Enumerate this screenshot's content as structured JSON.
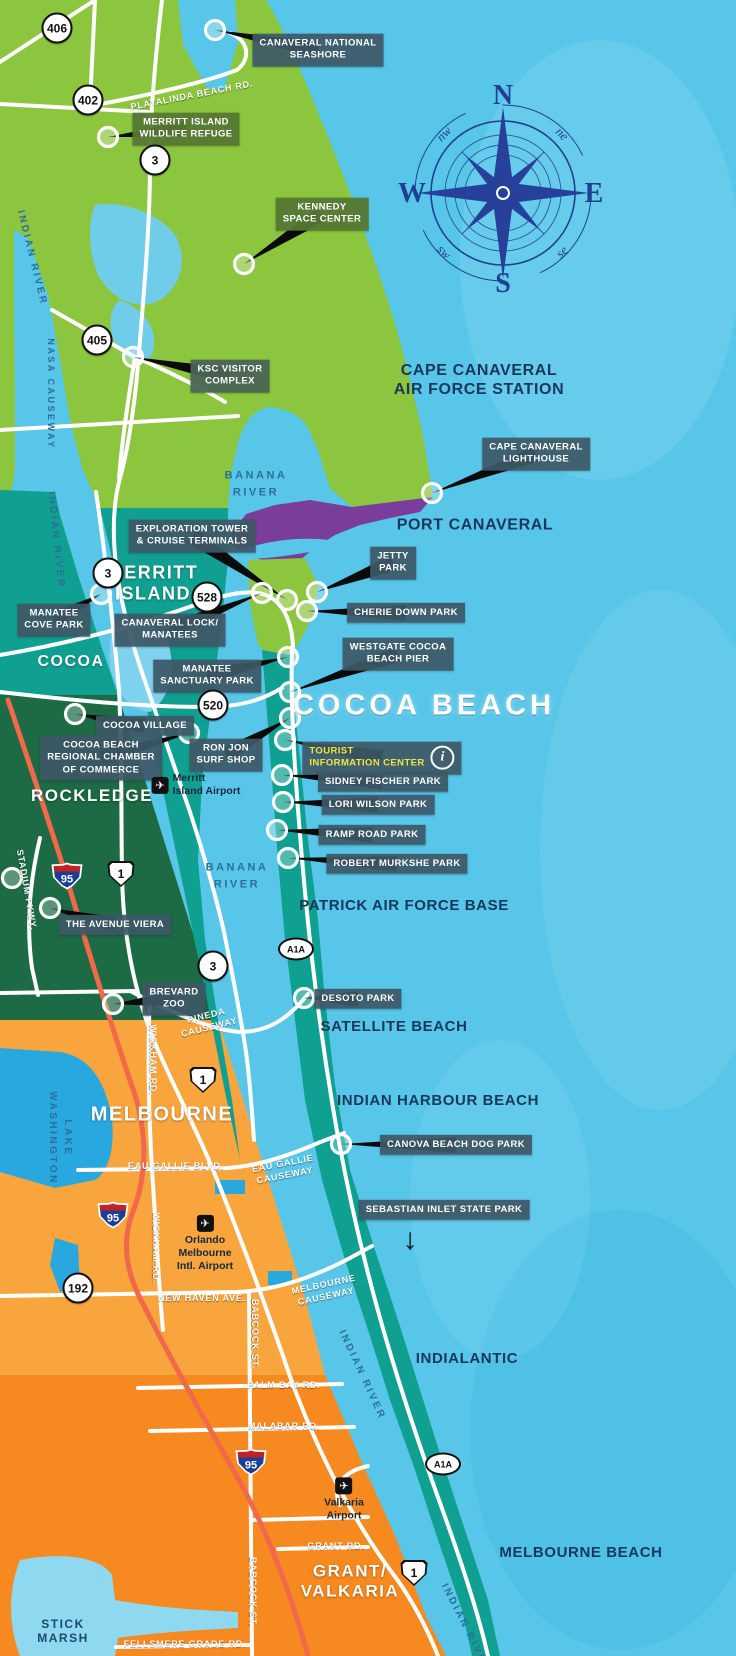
{
  "map_title": "Cocoa Beach / Space Coast Area Tourist Map",
  "compass": {
    "n": "N",
    "e": "E",
    "s": "S",
    "w": "W",
    "ne": "ne",
    "nw": "nw",
    "se": "se",
    "sw": "sw"
  },
  "colors": {
    "ocean": "#58c6e9",
    "green": "#8cc63e",
    "teal": "#10a091",
    "purple": "#7a3d9c",
    "dark_green": "#1c6b45",
    "orange": "#f9a53d",
    "dark_orange": "#f6891f",
    "lake": "#29a8e0",
    "road": "#ffffff",
    "i95_line": "#f2684a",
    "steel_box": "#3d5866",
    "olive_box": "#567834",
    "navy_text": "#17375c",
    "yellow_text": "#f0e83c"
  },
  "poi": [
    {
      "id": "canaveral-national-seashore",
      "lines": [
        "CANAVERAL NATIONAL",
        "SEASHORE"
      ],
      "style": "steel",
      "box": [
        318,
        50
      ],
      "marker": [
        215,
        30
      ]
    },
    {
      "id": "merritt-island-wildlife-refuge",
      "lines": [
        "MERRITT ISLAND",
        "WILDLIFE REFUGE"
      ],
      "style": "olive",
      "box": [
        186,
        129
      ],
      "marker": [
        108,
        137
      ]
    },
    {
      "id": "kennedy-space-center",
      "lines": [
        "KENNEDY",
        "SPACE CENTER"
      ],
      "style": "olive",
      "box": [
        322,
        214
      ],
      "marker": [
        244,
        264
      ]
    },
    {
      "id": "ksc-visitor-complex",
      "lines": [
        "KSC VISITOR",
        "COMPLEX"
      ],
      "style": "sage",
      "box": [
        230,
        376
      ],
      "marker": [
        133,
        357
      ]
    },
    {
      "id": "cape-canaveral-lighthouse",
      "lines": [
        "CAPE CANAVERAL",
        "LIGHTHOUSE"
      ],
      "style": "steel",
      "box": [
        536,
        454
      ],
      "marker": [
        432,
        493
      ]
    },
    {
      "id": "exploration-tower-cruise-terminals",
      "lines": [
        "EXPLORATION TOWER",
        "& CRUISE TERMINALS"
      ],
      "style": "steel",
      "box": [
        192,
        536
      ],
      "marker": [
        287,
        600
      ]
    },
    {
      "id": "jetty-park",
      "lines": [
        "JETTY",
        "PARK"
      ],
      "style": "steel",
      "box": [
        393,
        563
      ],
      "marker": [
        317,
        592
      ]
    },
    {
      "id": "cherie-down-park",
      "lines": [
        "CHERIE DOWN PARK"
      ],
      "style": "steel",
      "box": [
        406,
        613
      ],
      "marker": [
        307,
        611
      ]
    },
    {
      "id": "manatee-cove-park",
      "lines": [
        "MANATEE",
        "COVE PARK"
      ],
      "style": "steel",
      "box": [
        54,
        620
      ],
      "marker": [
        101,
        594
      ]
    },
    {
      "id": "canaveral-lock-manatees",
      "lines": [
        "CANAVERAL LOCK/",
        "MANATEES"
      ],
      "style": "steel",
      "box": [
        170,
        630
      ],
      "marker": [
        262,
        593
      ]
    },
    {
      "id": "westgate-cocoa-beach-pier",
      "lines": [
        "WESTGATE COCOA",
        "BEACH PIER"
      ],
      "style": "steel",
      "box": [
        398,
        654
      ],
      "marker": [
        290,
        692
      ]
    },
    {
      "id": "manatee-sanctuary-park",
      "lines": [
        "MANATEE",
        "SANCTUARY PARK"
      ],
      "style": "steel",
      "box": [
        207,
        676
      ],
      "marker": [
        288,
        657
      ]
    },
    {
      "id": "cocoa-village",
      "lines": [
        "COCOA VILLAGE"
      ],
      "style": "steel",
      "box": [
        145,
        726
      ],
      "marker": [
        75,
        714
      ]
    },
    {
      "id": "cocoa-beach-regional-chamber-of-commerce",
      "lines": [
        "COCOA BEACH",
        "REGIONAL CHAMBER",
        "OF COMMERCE"
      ],
      "style": "steel",
      "box": [
        101,
        758
      ],
      "marker": [
        189,
        733
      ]
    },
    {
      "id": "ron-jon-surf-shop",
      "lines": [
        "RON JON",
        "SURF SHOP"
      ],
      "style": "steel",
      "box": [
        226,
        755
      ],
      "marker": [
        290,
        718
      ]
    },
    {
      "id": "tourist-information-center",
      "lines": [
        "TOURIST",
        "INFORMATION CENTER"
      ],
      "style": "steel",
      "tourist": true,
      "box": [
        382,
        758
      ],
      "marker": [
        285,
        740
      ]
    },
    {
      "id": "sidney-fischer-park",
      "lines": [
        "SIDNEY FISCHER PARK"
      ],
      "style": "steel",
      "box": [
        383,
        782
      ],
      "marker": [
        282,
        775
      ]
    },
    {
      "id": "lori-wilson-park",
      "lines": [
        "LORI WILSON PARK"
      ],
      "style": "steel",
      "box": [
        378,
        805
      ],
      "marker": [
        283,
        802
      ]
    },
    {
      "id": "ramp-road-park",
      "lines": [
        "RAMP ROAD PARK"
      ],
      "style": "steel",
      "box": [
        372,
        835
      ],
      "marker": [
        277,
        830
      ]
    },
    {
      "id": "robert-murkshe-park",
      "lines": [
        "ROBERT MURKSHE PARK"
      ],
      "style": "steel",
      "box": [
        397,
        864
      ],
      "marker": [
        288,
        858
      ]
    },
    {
      "id": "the-avenue-viera",
      "lines": [
        "THE AVENUE VIERA"
      ],
      "style": "steel",
      "box": [
        115,
        925
      ],
      "marker": [
        50,
        908
      ]
    },
    {
      "id": "brevard-zoo",
      "lines": [
        "BREVARD",
        "ZOO"
      ],
      "style": "steel",
      "box": [
        174,
        999
      ],
      "marker": [
        113,
        1004
      ]
    },
    {
      "id": "desoto-park",
      "lines": [
        "DESOTO PARK"
      ],
      "style": "steel",
      "box": [
        358,
        999
      ],
      "marker": [
        304,
        998
      ]
    },
    {
      "id": "canova-beach-dog-park",
      "lines": [
        "CANOVA BEACH DOG PARK"
      ],
      "style": "steel",
      "box": [
        456,
        1145
      ],
      "marker": [
        341,
        1144
      ]
    },
    {
      "id": "sebastian-inlet-state-park",
      "lines": [
        "SEBASTIAN INLET STATE PARK"
      ],
      "style": "steel",
      "box": [
        444,
        1210
      ],
      "marker": null
    }
  ],
  "extra_markers": [
    [
      12,
      878
    ]
  ],
  "cities": [
    {
      "id": "merritt-island",
      "lines": [
        "MERRITT",
        "ISLAND"
      ],
      "x": 153,
      "y": 583,
      "size": 18
    },
    {
      "id": "cocoa",
      "lines": [
        "COCOA"
      ],
      "x": 71,
      "y": 662,
      "size": 16
    },
    {
      "id": "rockledge",
      "lines": [
        "ROCKLEDGE"
      ],
      "x": 92,
      "y": 796,
      "size": 17
    },
    {
      "id": "melbourne",
      "lines": [
        "MELBOURNE"
      ],
      "x": 162,
      "y": 1115,
      "size": 20
    },
    {
      "id": "grant-valkaria",
      "lines": [
        "GRANT/",
        "VALKARIA"
      ],
      "x": 350,
      "y": 1581,
      "size": 17
    }
  ],
  "areas": [
    {
      "id": "cape-canaveral-air-force-station",
      "lines": [
        "CAPE CANAVERAL",
        "AIR FORCE STATION"
      ],
      "x": 479,
      "y": 380,
      "size": 16
    },
    {
      "id": "port-canaveral",
      "lines": [
        "PORT CANAVERAL"
      ],
      "x": 475,
      "y": 525,
      "size": 16
    },
    {
      "id": "cocoa-beach",
      "lines": [
        "COCOA BEACH"
      ],
      "x": 424,
      "y": 706,
      "size": 29,
      "hero": true
    },
    {
      "id": "patrick-air-force-base",
      "lines": [
        "PATRICK AIR FORCE BASE"
      ],
      "x": 404,
      "y": 906,
      "size": 15
    },
    {
      "id": "satellite-beach",
      "lines": [
        "SATELLITE BEACH"
      ],
      "x": 394,
      "y": 1027,
      "size": 15
    },
    {
      "id": "indian-harbour-beach",
      "lines": [
        "INDIAN HARBOUR BEACH"
      ],
      "x": 438,
      "y": 1101,
      "size": 15
    },
    {
      "id": "indialantic",
      "lines": [
        "INDIALANTIC"
      ],
      "x": 467,
      "y": 1359,
      "size": 15
    },
    {
      "id": "melbourne-beach",
      "lines": [
        "MELBOURNE BEACH"
      ],
      "x": 581,
      "y": 1553,
      "size": 15
    }
  ],
  "waters": [
    {
      "id": "indian-river-n",
      "lines": [
        "INDIAN RIVER"
      ],
      "x": 32,
      "y": 258,
      "rot": 76,
      "size": 10
    },
    {
      "id": "nasa-causeway",
      "lines": [
        "NASA CAUSEWAY"
      ],
      "x": 50,
      "y": 394,
      "rot": 90,
      "size": 9
    },
    {
      "id": "indian-river-mid",
      "lines": [
        "INDIAN RIVER"
      ],
      "x": 56,
      "y": 540,
      "rot": 84,
      "size": 10
    },
    {
      "id": "banana-river-n",
      "lines": [
        "BANANA",
        "RIVER"
      ],
      "x": 256,
      "y": 484,
      "rot": 0,
      "size": 11
    },
    {
      "id": "banana-river-s",
      "lines": [
        "BANANA",
        "RIVER"
      ],
      "x": 237,
      "y": 876,
      "rot": 0,
      "size": 11
    },
    {
      "id": "lake-washington",
      "lines": [
        "LAKE",
        "WASHINGTON"
      ],
      "x": 60,
      "y": 1138,
      "rot": 90,
      "size": 10
    },
    {
      "id": "indian-river-s1",
      "lines": [
        "INDIAN RIVER"
      ],
      "x": 362,
      "y": 1375,
      "rot": 65,
      "size": 10
    },
    {
      "id": "indian-river-s2",
      "lines": [
        "INDIAN RIVER"
      ],
      "x": 466,
      "y": 1628,
      "rot": 63,
      "size": 10
    }
  ],
  "stick_marsh": {
    "id": "stick-marsh",
    "lines": [
      "STICK",
      "MARSH"
    ],
    "x": 63,
    "y": 1631,
    "size": 12
  },
  "road_labels": [
    {
      "id": "playalinda-beach-rd",
      "lines": [
        "PLAYALINDA BEACH RD."
      ],
      "x": 192,
      "y": 96,
      "rot": -11
    },
    {
      "id": "pineda-causeway",
      "lines": [
        "PINEDA",
        "CAUSEWAY"
      ],
      "x": 208,
      "y": 1022,
      "rot": -14
    },
    {
      "id": "eau-gallie-blvd",
      "lines": [
        "EAU GALLIE BLVD."
      ],
      "x": 176,
      "y": 1167,
      "rot": 0
    },
    {
      "id": "eau-gallie-causeway",
      "lines": [
        "EAU GALLIE",
        "CAUSEWAY"
      ],
      "x": 284,
      "y": 1170,
      "rot": -11
    },
    {
      "id": "new-haven-ave",
      "lines": [
        "NEW HAVEN AVE."
      ],
      "x": 202,
      "y": 1299,
      "rot": 0
    },
    {
      "id": "melbourne-causeway",
      "lines": [
        "MELBOURNE",
        "CAUSEWAY"
      ],
      "x": 325,
      "y": 1291,
      "rot": -12
    },
    {
      "id": "palm-bay-rd",
      "lines": [
        "PALM BAY RD."
      ],
      "x": 284,
      "y": 1386,
      "rot": 0
    },
    {
      "id": "malabar-rd",
      "lines": [
        "MALABAR RD."
      ],
      "x": 284,
      "y": 1427,
      "rot": 0
    },
    {
      "id": "grant-rd",
      "lines": [
        "GRANT RD."
      ],
      "x": 336,
      "y": 1547,
      "rot": 0
    },
    {
      "id": "fellsmere-grade-rd",
      "lines": [
        "FELLSMERE GRADE  RD."
      ],
      "x": 185,
      "y": 1645,
      "rot": 0
    },
    {
      "id": "wickham-rd-n",
      "lines": [
        "WICKHAM RD."
      ],
      "x": 152,
      "y": 1060,
      "rot": 90
    },
    {
      "id": "wickham-rd-s",
      "lines": [
        "WICKHAM RD."
      ],
      "x": 155,
      "y": 1248,
      "rot": 90
    },
    {
      "id": "babcock-st-n",
      "lines": [
        "BABCOCK ST."
      ],
      "x": 254,
      "y": 1334,
      "rot": 90
    },
    {
      "id": "babcock-st-s",
      "lines": [
        "BABCOCK ST."
      ],
      "x": 252,
      "y": 1592,
      "rot": 90
    },
    {
      "id": "stadium-pkwy",
      "lines": [
        "STADIUM PKWY."
      ],
      "x": 26,
      "y": 890,
      "rot": 80
    }
  ],
  "shields": [
    {
      "type": "circle",
      "text": "406",
      "x": 57,
      "y": 28
    },
    {
      "type": "circle",
      "text": "402",
      "x": 88,
      "y": 100
    },
    {
      "type": "circle",
      "text": "3",
      "x": 155,
      "y": 160
    },
    {
      "type": "circle",
      "text": "405",
      "x": 97,
      "y": 340
    },
    {
      "type": "circle",
      "text": "3",
      "x": 108,
      "y": 573
    },
    {
      "type": "circle",
      "text": "528",
      "x": 207,
      "y": 597
    },
    {
      "type": "circle",
      "text": "520",
      "x": 213,
      "y": 705
    },
    {
      "type": "circle",
      "text": "3",
      "x": 213,
      "y": 966
    },
    {
      "type": "circle",
      "text": "192",
      "x": 78,
      "y": 1288
    },
    {
      "type": "us",
      "text": "1",
      "x": 121,
      "y": 874
    },
    {
      "type": "us",
      "text": "1",
      "x": 203,
      "y": 1080
    },
    {
      "type": "us",
      "text": "1",
      "x": 414,
      "y": 1573
    },
    {
      "type": "i95",
      "text": "95",
      "x": 67,
      "y": 876
    },
    {
      "type": "i95",
      "text": "95",
      "x": 113,
      "y": 1215
    },
    {
      "type": "i95",
      "text": "95",
      "x": 251,
      "y": 1462
    },
    {
      "type": "a1a",
      "text": "A1A",
      "x": 296,
      "y": 949
    },
    {
      "type": "a1a",
      "text": "A1A",
      "x": 443,
      "y": 1464
    }
  ],
  "airports": [
    {
      "id": "merritt-island-airport",
      "lines": [
        "Merritt",
        "Island Airport"
      ],
      "x": 196,
      "y": 785,
      "layout": "right",
      "icon": "✈"
    },
    {
      "id": "orlando-melbourne-intl-airport",
      "lines": [
        "Orlando",
        "Melbourne",
        "Intl. Airport"
      ],
      "x": 205,
      "y": 1244,
      "layout": "below",
      "icon": "✈"
    },
    {
      "id": "valkaria-airport",
      "lines": [
        "Valkaria",
        "Airport"
      ],
      "x": 344,
      "y": 1500,
      "layout": "below",
      "icon": "✈"
    }
  ],
  "misc": {
    "down_arrow": "↓",
    "down_arrow_x": 410,
    "down_arrow_y": 1240,
    "info_symbol": "i"
  }
}
